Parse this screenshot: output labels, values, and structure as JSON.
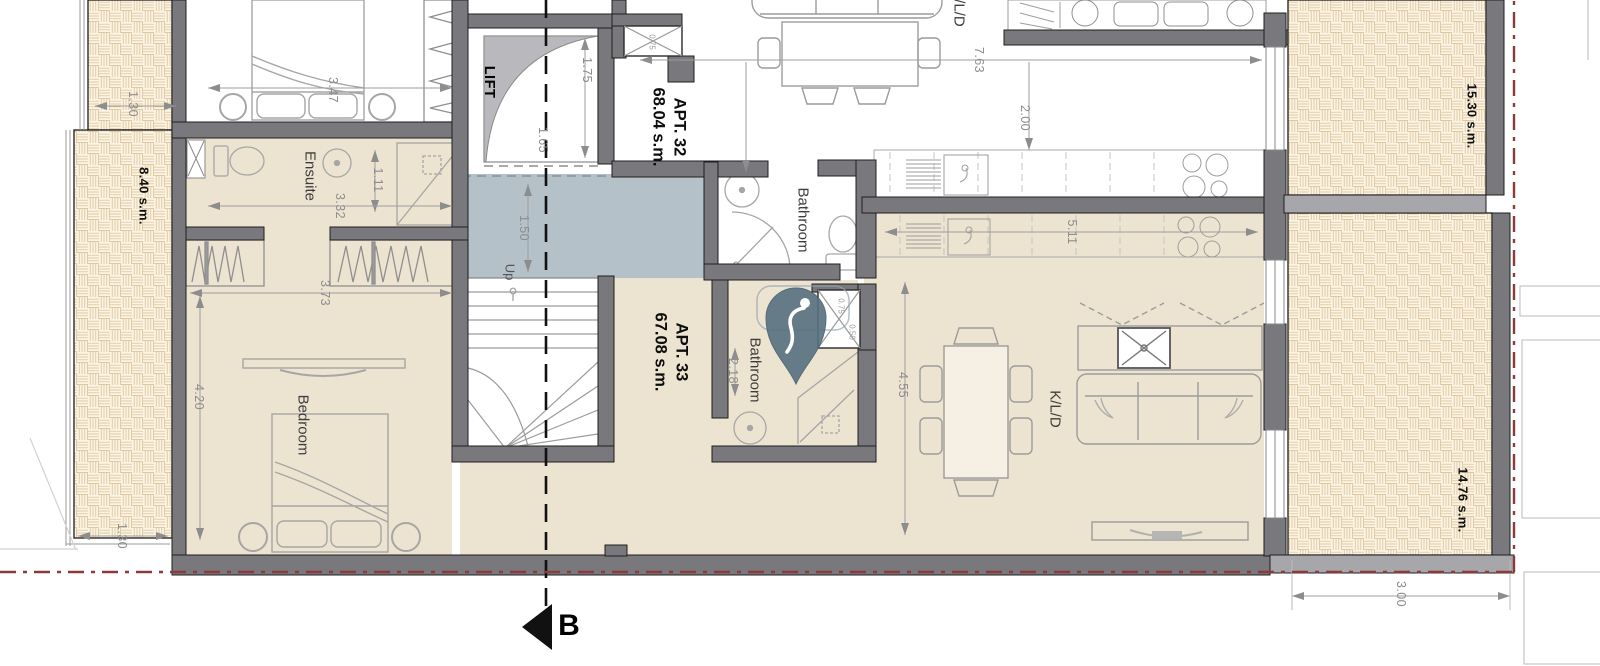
{
  "title": "Apartment floor plan - APT. 32 and APT. 33",
  "labels": {
    "apt32_line1": "APT. 32",
    "apt32_line2": "68.04 s.m.",
    "apt33_line1": "APT. 33",
    "apt33_line2": "67.08 s.m.",
    "lift": "LIFT",
    "up": "Up",
    "ensuite": "Ensuite",
    "bedroom": "Bedroom",
    "bathroom_apt32": "Bathroom",
    "bathroom_apt33": "Bathroom",
    "kld_apt32": "K/L/D",
    "kld_apt33": "K/L/D",
    "area_left_terrace": "8.40 s.m.",
    "area_top_right_terrace": "15.30 s.m.",
    "area_bottom_right_terrace": "14.76 s.m.",
    "section_marker": "B",
    "dims": {
      "d347": "3.47",
      "d130t": "1.30",
      "d111": "1.11",
      "d332": "3.32",
      "d373": "3.73",
      "d420": "4.20",
      "d130b": "1.30",
      "d175": "1.75",
      "d165": "1.65",
      "d150": "1.50",
      "d763": "7.63",
      "d200": "2.00",
      "d511": "5.11",
      "d455": "4.55",
      "d218": "2.18",
      "d300": "3.00",
      "d075a": "0.75",
      "d075b": "0.75",
      "d050": "0.50"
    }
  },
  "colors": {
    "wall": "#78787d",
    "wall_light": "#a7a7ab",
    "floor": "#ede3d1",
    "corridor": "#b5c1c9",
    "hatch_line": "#d6ba90",
    "boundary": "#8d3a3a",
    "pin": "#57707f"
  }
}
